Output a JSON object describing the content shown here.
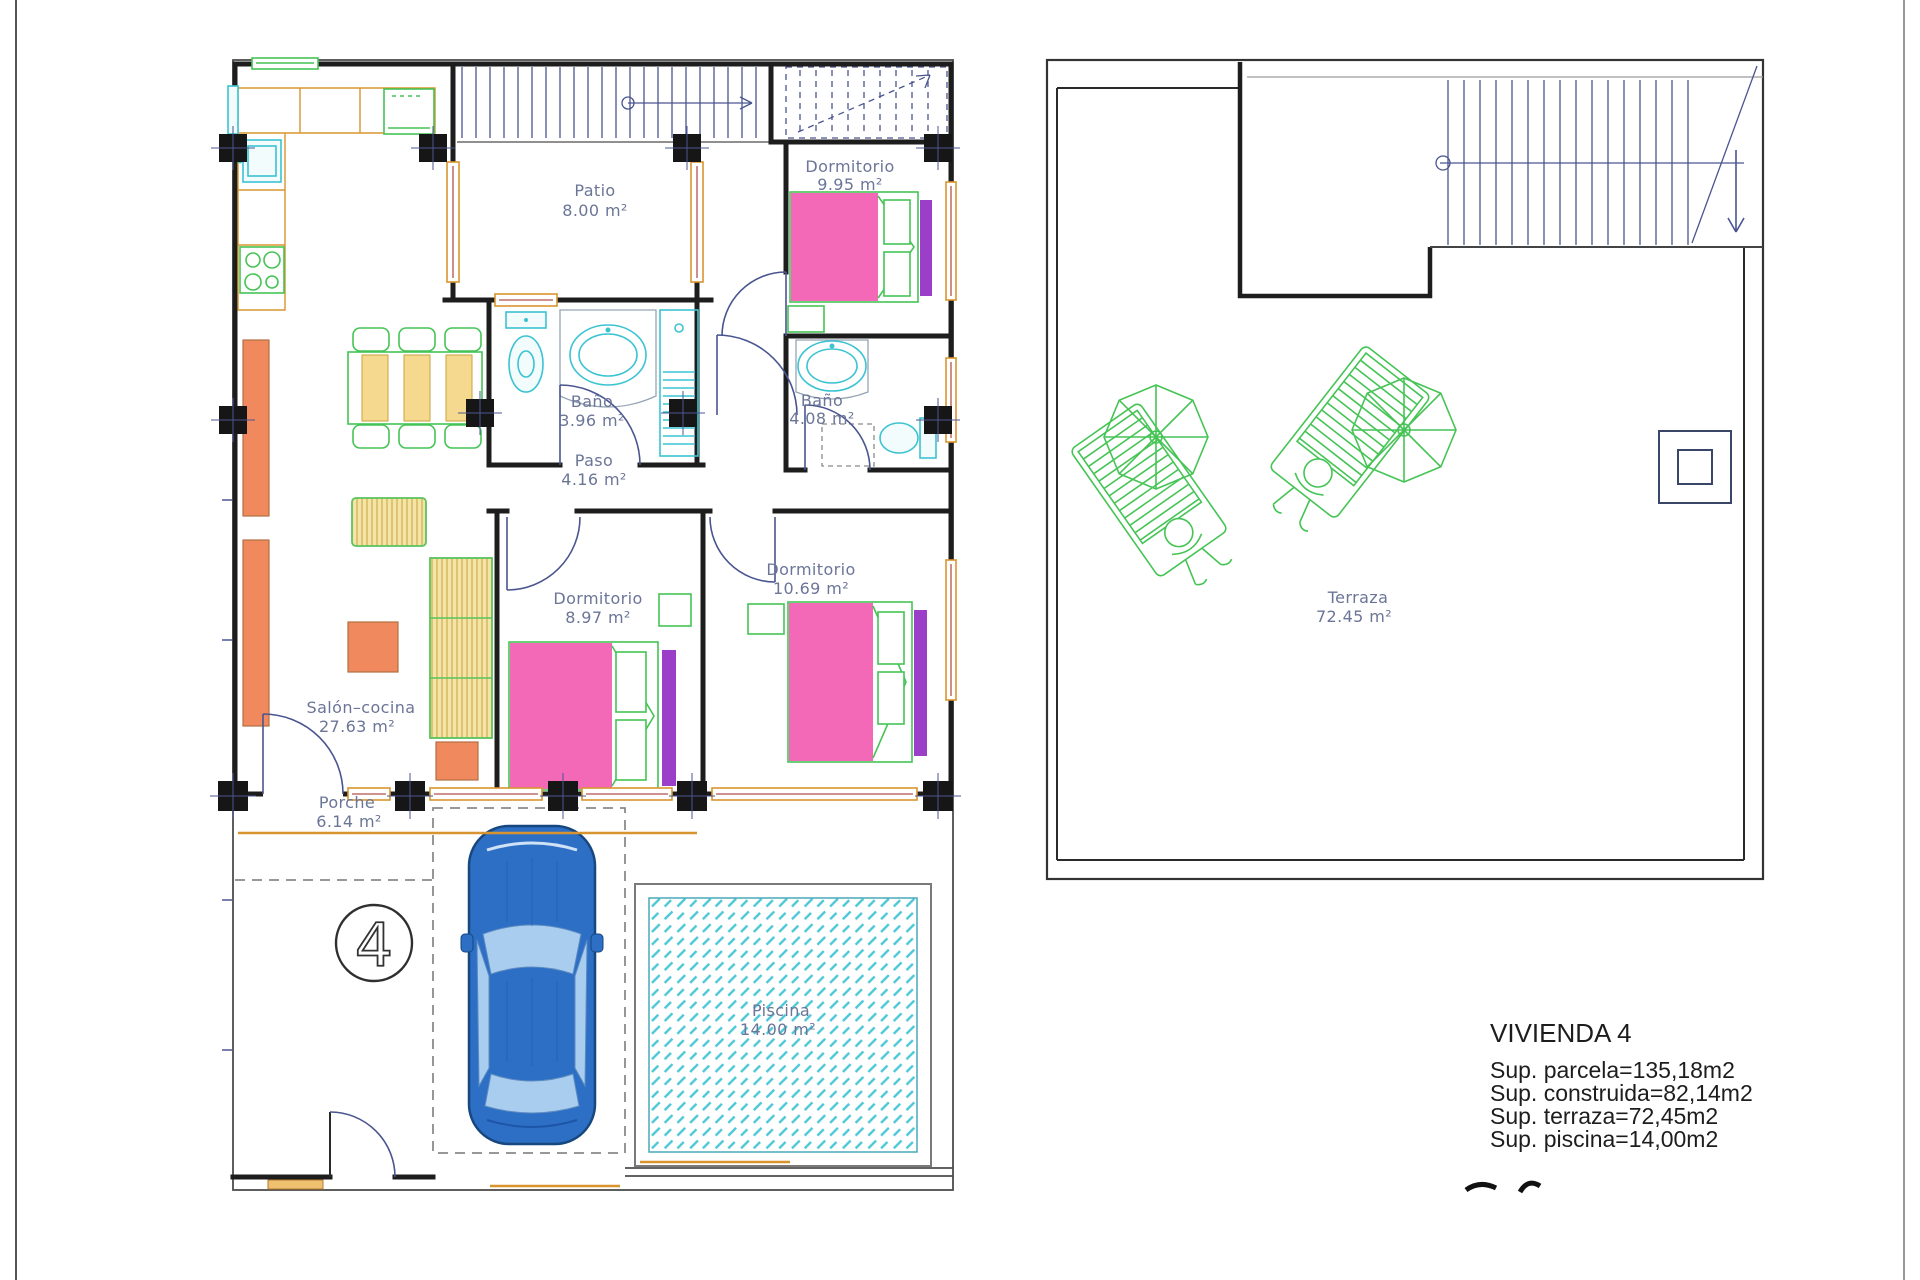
{
  "colors": {
    "wall": "#1d1d1d",
    "label_text": "#6b7597",
    "summary_text": "#1d1d1d",
    "window_frame": "#d8952f",
    "furniture_orange": "#f08a5e",
    "furniture_yellow": "#f5d98f",
    "green": "#45c455",
    "cyan": "#3cc3d2",
    "bed_pink": "#f468b8",
    "bed_purple": "#9b3ec8",
    "car_blue": "#2e6fc6",
    "stair_blue": "#4a5590",
    "pool_hatch": "#4cc7d6"
  },
  "left_plan": {
    "unit_number": "4",
    "rooms": [
      {
        "name": "Patio",
        "area": "8.00 m²"
      },
      {
        "name": "Dormitorio",
        "area": "9.95 m²"
      },
      {
        "name": "Baño",
        "area": "3.96 m²"
      },
      {
        "name": "Baño",
        "area": "4.08 m²"
      },
      {
        "name": "Paso",
        "area": "4.16 m²"
      },
      {
        "name": "Dormitorio",
        "area": "8.97 m²"
      },
      {
        "name": "Dormitorio",
        "area": "10.69 m²"
      },
      {
        "name": "Salón–cocina",
        "area": "27.63 m²"
      },
      {
        "name": "Porche",
        "area": "6.14 m²"
      },
      {
        "name": "Piscina",
        "area": "14.00 m²"
      }
    ]
  },
  "right_plan": {
    "rooms": [
      {
        "name": "Terraza",
        "area": "72.45 m²"
      }
    ]
  },
  "summary": {
    "title": "VIVIENDA 4",
    "lines": [
      "Sup. parcela=135,18m2",
      "Sup. construida=82,14m2",
      "Sup. terraza=72,45m2",
      "Sup. piscina=14,00m2"
    ]
  }
}
